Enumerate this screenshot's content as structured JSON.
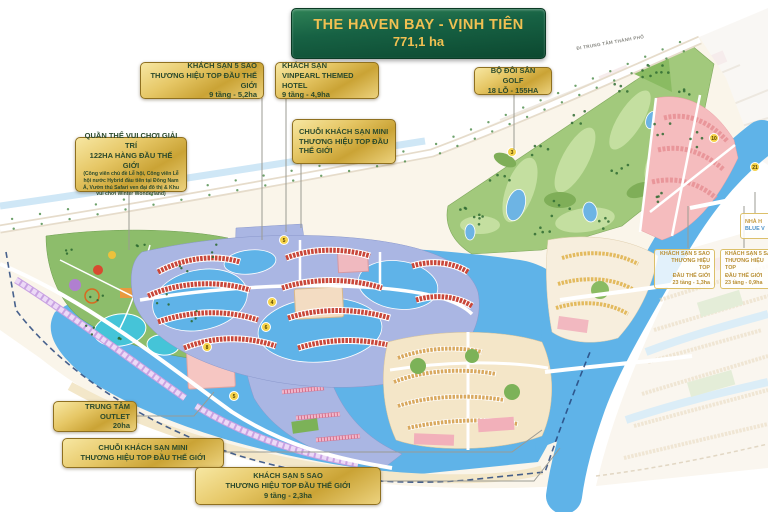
{
  "banner": {
    "title": "THE HAVEN BAY - VỊNH TIÊN",
    "area": "771,1 ha",
    "bg_color": "#15623c",
    "text_color": "#f0c052"
  },
  "road_label": "ĐI TRUNG TÂM THÀNH PHỐ",
  "callouts": [
    {
      "id": "hotel-5sao-52ha",
      "lines": [
        "KHÁCH SẠN 5 SAO",
        "THƯƠNG HIỆU TOP ĐẦU THẾ GIỚI",
        "9 tầng - 5,2ha"
      ]
    },
    {
      "id": "vinpearl-hotel",
      "lines": [
        "KHÁCH SẠN",
        "VINPEARL THEMED HOTEL",
        "9 tầng - 4,9ha"
      ]
    },
    {
      "id": "golf",
      "lines": [
        "BỘ ĐÔI SÂN GOLF",
        "18 LỖ - 155HA"
      ]
    },
    {
      "id": "mini-hotels-top",
      "lines": [
        "CHUỖI KHÁCH SẠN MINI",
        "THƯƠNG HIỆU TOP ĐẦU",
        "THẾ GIỚI"
      ]
    },
    {
      "id": "theme-park",
      "lines": [
        "QUẦN THỂ VUI CHƠI GIẢI TRÍ",
        "122HA HÀNG ĐẦU THẾ GIỚI"
      ],
      "sub": "(Công viên chủ đề Lễ hội, Công viên Lễ hội nước Hybrid đầu tiên tại Đông Nam Á, Vườn thú Safari ven đại đô thị & Khu vui chơi Winter Wonderland)"
    },
    {
      "id": "outlet",
      "lines": [
        "TRUNG TÂM OUTLET",
        "20ha"
      ]
    },
    {
      "id": "mini-hotels-bottom",
      "lines": [
        "CHUỖI KHÁCH SẠN MINI",
        "THƯƠNG HIỆU TOP ĐẦU THẾ GIỚI"
      ]
    },
    {
      "id": "hotel-5sao-23ha",
      "lines": [
        "KHÁCH SẠN 5 SAO",
        "THƯƠNG HIỆU TOP ĐẦU THẾ GIỚI",
        "9 tầng - 2,3ha"
      ]
    },
    {
      "id": "hotel-23t-13ha",
      "lines": [
        "KHÁCH SẠN 5 SAO",
        "THƯƠNG HIỆU TOP",
        "ĐẦU THẾ GIỚI",
        "23 tầng - 1,3ha"
      ]
    },
    {
      "id": "hotel-23t-09ha",
      "lines": [
        "KHÁCH SẠN 5 SAO",
        "THƯƠNG HIỆU TOP",
        "ĐẦU THẾ GIỚI",
        "23 tầng - 0,9ha"
      ]
    },
    {
      "id": "blue-label",
      "lines": [
        "NHÀ H",
        "BLUE V"
      ]
    }
  ],
  "markers": [
    {
      "label": "3",
      "x": 512,
      "y": 152
    },
    {
      "label": "5",
      "x": 284,
      "y": 240
    },
    {
      "label": "4",
      "x": 272,
      "y": 302
    },
    {
      "label": "6",
      "x": 266,
      "y": 327
    },
    {
      "label": "8",
      "x": 207,
      "y": 347
    },
    {
      "label": "5",
      "x": 234,
      "y": 396
    },
    {
      "label": "10",
      "x": 714,
      "y": 138
    },
    {
      "label": "21",
      "x": 755,
      "y": 167
    }
  ],
  "colors": {
    "water": "#5fb3e8",
    "golf_green": "#a2c97c",
    "residential_pink": "#f5bcbe",
    "marina_base": "#aab6e3",
    "rowhouse_red": "#c9473a",
    "rowhouse_tan": "#d9a95f",
    "lavender": "#dcbaee",
    "gold": "#d9b54a",
    "banner_green": "#156140"
  }
}
